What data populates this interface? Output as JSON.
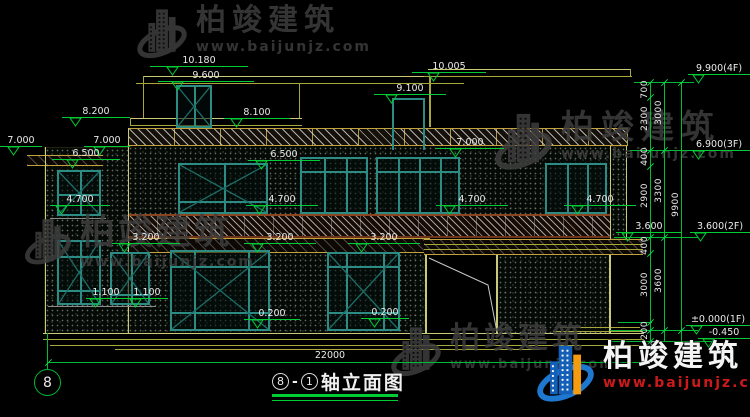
{
  "title": {
    "axis_from": "8",
    "axis_to": "1",
    "name": "轴立面图"
  },
  "axis_bubble": {
    "label": "8"
  },
  "bottom_dimension": "22000",
  "watermark": {
    "brand": "柏竣建筑",
    "url": "www.baijunjz.com"
  },
  "watermark_instances": [
    {
      "x": 136,
      "y": 6,
      "variant": "gray",
      "brand_size": 30,
      "logo_h": 56,
      "url_size": 14,
      "ls": 6
    },
    {
      "x": 494,
      "y": 110,
      "variant": "gray",
      "brand_size": 33,
      "logo_h": 64,
      "url_size": 14,
      "ls": 7
    },
    {
      "x": 24,
      "y": 216,
      "variant": "gray",
      "brand_size": 35,
      "logo_h": 52,
      "url_size": 14,
      "ls": 3
    },
    {
      "x": 390,
      "y": 324,
      "variant": "gray",
      "brand_size": 30,
      "logo_h": 56,
      "url_size": 13,
      "ls": 4
    },
    {
      "x": 536,
      "y": 342,
      "variant": "color",
      "brand_size": 30,
      "logo_h": 64,
      "url_size": 14,
      "ls": 5
    }
  ],
  "dimensions": {
    "levels": [
      {
        "label": "10.180",
        "x": 150,
        "y": 55,
        "w": 98,
        "tx": 16
      },
      {
        "label": "9.600",
        "x": 158,
        "y": 70,
        "w": 96,
        "tx": 13
      },
      {
        "label": "10.005",
        "x": 412,
        "y": 61,
        "w": 74,
        "tx": 15
      },
      {
        "label": "9.100",
        "x": 374,
        "y": 83,
        "w": 72,
        "tx": 11
      },
      {
        "label": "8.200",
        "x": 62,
        "y": 106,
        "w": 68,
        "tx": 7
      },
      {
        "label": "8.100",
        "x": 224,
        "y": 107,
        "w": 66,
        "tx": 6
      },
      {
        "label": "7.000",
        "x": 0,
        "y": 135,
        "w": 42,
        "tx": 7
      },
      {
        "label": "7.000",
        "x": 84,
        "y": 135,
        "w": 46,
        "tx": 9
      },
      {
        "label": "6.500",
        "x": 52,
        "y": 148,
        "w": 68,
        "tx": 14
      },
      {
        "label": "7.000",
        "x": 436,
        "y": 137,
        "w": 68,
        "tx": 13
      },
      {
        "label": "6.500",
        "x": 248,
        "y": 149,
        "w": 72,
        "tx": 7
      },
      {
        "label": "4.700",
        "x": 50,
        "y": 194,
        "w": 60,
        "tx": 5
      },
      {
        "label": "4.700",
        "x": 246,
        "y": 194,
        "w": 72,
        "tx": 7
      },
      {
        "label": "4.700",
        "x": 436,
        "y": 194,
        "w": 72,
        "tx": 7
      },
      {
        "label": "4.700",
        "x": 564,
        "y": 194,
        "w": 72,
        "tx": 7
      },
      {
        "label": "3.200",
        "x": 112,
        "y": 232,
        "w": 68,
        "tx": 6
      },
      {
        "label": "3.200",
        "x": 244,
        "y": 232,
        "w": 72,
        "tx": 7
      },
      {
        "label": "3.200",
        "x": 348,
        "y": 232,
        "w": 72,
        "tx": 7
      },
      {
        "label": "3.600",
        "x": 616,
        "y": 221,
        "w": 66,
        "tx": 5
      },
      {
        "label": "1.100",
        "x": 86,
        "y": 287,
        "w": 40,
        "tx": 3
      },
      {
        "label": "1.100",
        "x": 126,
        "y": 287,
        "w": 42,
        "tx": 3
      },
      {
        "label": "0.200",
        "x": 244,
        "y": 308,
        "w": 56,
        "tx": 7
      },
      {
        "label": "0.200",
        "x": 361,
        "y": 307,
        "w": 48,
        "tx": 7
      },
      {
        "label": "9.900(4F)",
        "x": 688,
        "y": 63,
        "w": 62,
        "tx": 4
      },
      {
        "label": "6.900(3F)",
        "x": 688,
        "y": 139,
        "w": 62,
        "tx": 4
      },
      {
        "label": "3.600(2F)",
        "x": 690,
        "y": 221,
        "w": 60,
        "tx": 4
      },
      {
        "label": "±0.000(1F)",
        "x": 686,
        "y": 314,
        "w": 64,
        "tx": 4
      },
      {
        "label": "-0.450",
        "x": 698,
        "y": 327,
        "w": 52,
        "tx": 4
      }
    ],
    "vertical_dims": [
      {
        "t": "700",
        "x": 640,
        "y": 80
      },
      {
        "t": "2300",
        "x": 640,
        "y": 106
      },
      {
        "t": "400",
        "x": 640,
        "y": 147
      },
      {
        "t": "2900",
        "x": 640,
        "y": 183
      },
      {
        "t": "400",
        "x": 640,
        "y": 236
      },
      {
        "t": "3000",
        "x": 640,
        "y": 272
      },
      {
        "t": "200",
        "x": 640,
        "y": 321
      },
      {
        "t": "250",
        "x": 650,
        "y": 340
      },
      {
        "t": "3000",
        "x": 654,
        "y": 100
      },
      {
        "t": "3300",
        "x": 654,
        "y": 178
      },
      {
        "t": "3600",
        "x": 654,
        "y": 268
      },
      {
        "t": "9900",
        "x": 671,
        "y": 192
      }
    ]
  },
  "colors": {
    "dim_green": "#00cc33",
    "line_yellow": "#a8a83a",
    "window_teal": "#2c8c84",
    "text_white": "#eaeaea",
    "brand_red": "#cc1a1a",
    "brand_blue": "#1460b8",
    "brand_orange": "#f59b10"
  }
}
